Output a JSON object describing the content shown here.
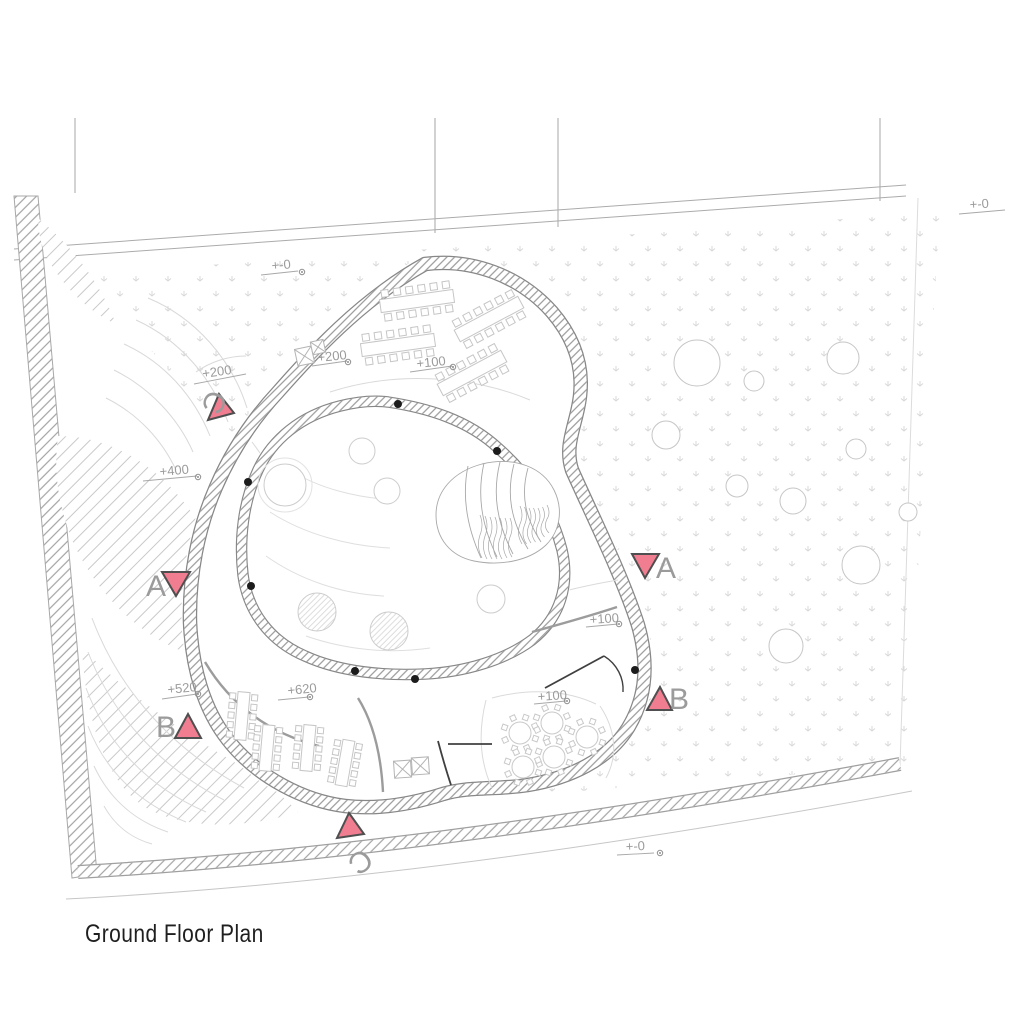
{
  "title": "Ground Floor Plan",
  "colors": {
    "marker_fill": "#f17e90",
    "marker_stroke": "#4f4f4f",
    "letter": "#9b9b9b",
    "label": "#9b9b9b",
    "wall_edge": "#878787",
    "furniture": "#c6c6c6",
    "column": "#1c1c1c"
  },
  "elevation_labels": [
    {
      "text": "+200",
      "x": 203,
      "y": 378,
      "rot": -8,
      "line": [
        194,
        384,
        246,
        374
      ],
      "dot": null
    },
    {
      "text": "+200",
      "x": 318,
      "y": 362,
      "rot": -6,
      "line": [
        312,
        366,
        347,
        361
      ],
      "dot": [
        348,
        362
      ]
    },
    {
      "text": "+100",
      "x": 417,
      "y": 368,
      "rot": -6,
      "line": [
        410,
        372,
        452,
        366
      ],
      "dot": [
        453,
        367
      ]
    },
    {
      "text": "+400",
      "x": 160,
      "y": 476,
      "rot": -5,
      "line": [
        143,
        481,
        197,
        476
      ],
      "dot": [
        198,
        477
      ]
    },
    {
      "text": "+520",
      "x": 168,
      "y": 694,
      "rot": -6,
      "line": [
        162,
        699,
        197,
        694
      ],
      "dot": [
        198,
        694
      ]
    },
    {
      "text": "+620",
      "x": 288,
      "y": 695,
      "rot": -6,
      "line": [
        278,
        700,
        309,
        697
      ],
      "dot": [
        310,
        697
      ]
    },
    {
      "text": "+100",
      "x": 590,
      "y": 624,
      "rot": -4,
      "line": [
        586,
        627,
        618,
        624
      ],
      "dot": [
        619,
        624
      ]
    },
    {
      "text": "+100",
      "x": 538,
      "y": 701,
      "rot": -4,
      "line": [
        534,
        704,
        566,
        701
      ],
      "dot": [
        567,
        701
      ]
    },
    {
      "text": "+-0",
      "x": 272,
      "y": 270,
      "rot": -5,
      "line": [
        261,
        275,
        298,
        271
      ],
      "dot": [
        302,
        272
      ]
    },
    {
      "text": "+-0",
      "x": 970,
      "y": 209,
      "rot": -4,
      "line": [
        959,
        214,
        1005,
        210
      ],
      "dot": null
    },
    {
      "text": "+-0",
      "x": 626,
      "y": 851,
      "rot": -3,
      "line": [
        617,
        855,
        654,
        853
      ],
      "dot": [
        660,
        853
      ]
    }
  ],
  "section_markers": [
    {
      "letter": "A",
      "x": 156,
      "y": 596,
      "rot": 0,
      "tri": [
        [
          162,
          572
        ],
        [
          190,
          572
        ],
        [
          176,
          596
        ]
      ]
    },
    {
      "letter": "A",
      "x": 666,
      "y": 578,
      "rot": 0,
      "tri": [
        [
          632,
          554
        ],
        [
          659,
          554
        ],
        [
          645,
          578
        ]
      ]
    },
    {
      "letter": "B",
      "x": 166,
      "y": 737,
      "rot": 0,
      "tri": [
        [
          175,
          738
        ],
        [
          201,
          738
        ],
        [
          188,
          714
        ]
      ]
    },
    {
      "letter": "B",
      "x": 679,
      "y": 709,
      "rot": 0,
      "tri": [
        [
          647,
          710
        ],
        [
          672,
          710
        ],
        [
          660,
          687
        ]
      ]
    },
    {
      "letter": "C",
      "x": 205,
      "y": 398,
      "rot": 115,
      "tri": [
        [
          208,
          420
        ],
        [
          234,
          413
        ],
        [
          219,
          394
        ]
      ]
    },
    {
      "letter": "C",
      "x": 354,
      "y": 854,
      "rot": 140,
      "tri": [
        [
          337,
          838
        ],
        [
          364,
          834
        ],
        [
          349,
          813
        ]
      ]
    }
  ],
  "site_trees": [
    [
      697,
      363,
      23
    ],
    [
      754,
      381,
      10
    ],
    [
      843,
      358,
      16
    ],
    [
      666,
      435,
      14
    ],
    [
      856,
      449,
      10
    ],
    [
      737,
      486,
      11
    ],
    [
      793,
      501,
      13
    ],
    [
      861,
      565,
      19
    ],
    [
      786,
      646,
      17
    ],
    [
      908,
      512,
      9
    ]
  ],
  "courtyard_trees": [
    [
      285,
      485,
      21,
      "outline"
    ],
    [
      362,
      451,
      13,
      "outline"
    ],
    [
      387,
      491,
      13,
      "outline"
    ],
    [
      317,
      612,
      19,
      "hatch"
    ],
    [
      389,
      631,
      19,
      "hatch"
    ],
    [
      491,
      599,
      14,
      "outline"
    ]
  ],
  "columns": [
    [
      398,
      404
    ],
    [
      497,
      451
    ],
    [
      248,
      482
    ],
    [
      251,
      586
    ],
    [
      355,
      671
    ],
    [
      415,
      679
    ],
    [
      635,
      670
    ]
  ],
  "furniture": {
    "long_tables": [
      {
        "x": 417,
        "y": 301,
        "rot": -8,
        "len": 74,
        "w": 13,
        "chairs": 6,
        "cs": 7
      },
      {
        "x": 489,
        "y": 319,
        "rot": -28,
        "len": 72,
        "w": 13,
        "chairs": 6,
        "cs": 7
      },
      {
        "x": 398,
        "y": 345,
        "rot": -8,
        "len": 74,
        "w": 13,
        "chairs": 6,
        "cs": 7
      },
      {
        "x": 472,
        "y": 373,
        "rot": -28,
        "len": 72,
        "w": 13,
        "chairs": 6,
        "cs": 7
      },
      {
        "x": 242,
        "y": 716,
        "rot": 95,
        "len": 48,
        "w": 12,
        "chairs": 5,
        "cs": 6
      },
      {
        "x": 267,
        "y": 748,
        "rot": 95,
        "len": 46,
        "w": 12,
        "chairs": 5,
        "cs": 6
      },
      {
        "x": 308,
        "y": 748,
        "rot": 95,
        "len": 46,
        "w": 12,
        "chairs": 5,
        "cs": 6
      },
      {
        "x": 345,
        "y": 763,
        "rot": 100,
        "len": 46,
        "w": 12,
        "chairs": 5,
        "cs": 6
      }
    ],
    "round_tables": {
      "positions": [
        [
          520,
          733
        ],
        [
          552,
          723
        ],
        [
          587,
          737
        ],
        [
          554,
          757
        ],
        [
          523,
          767
        ]
      ],
      "radius": 11,
      "chairs": 8
    }
  }
}
